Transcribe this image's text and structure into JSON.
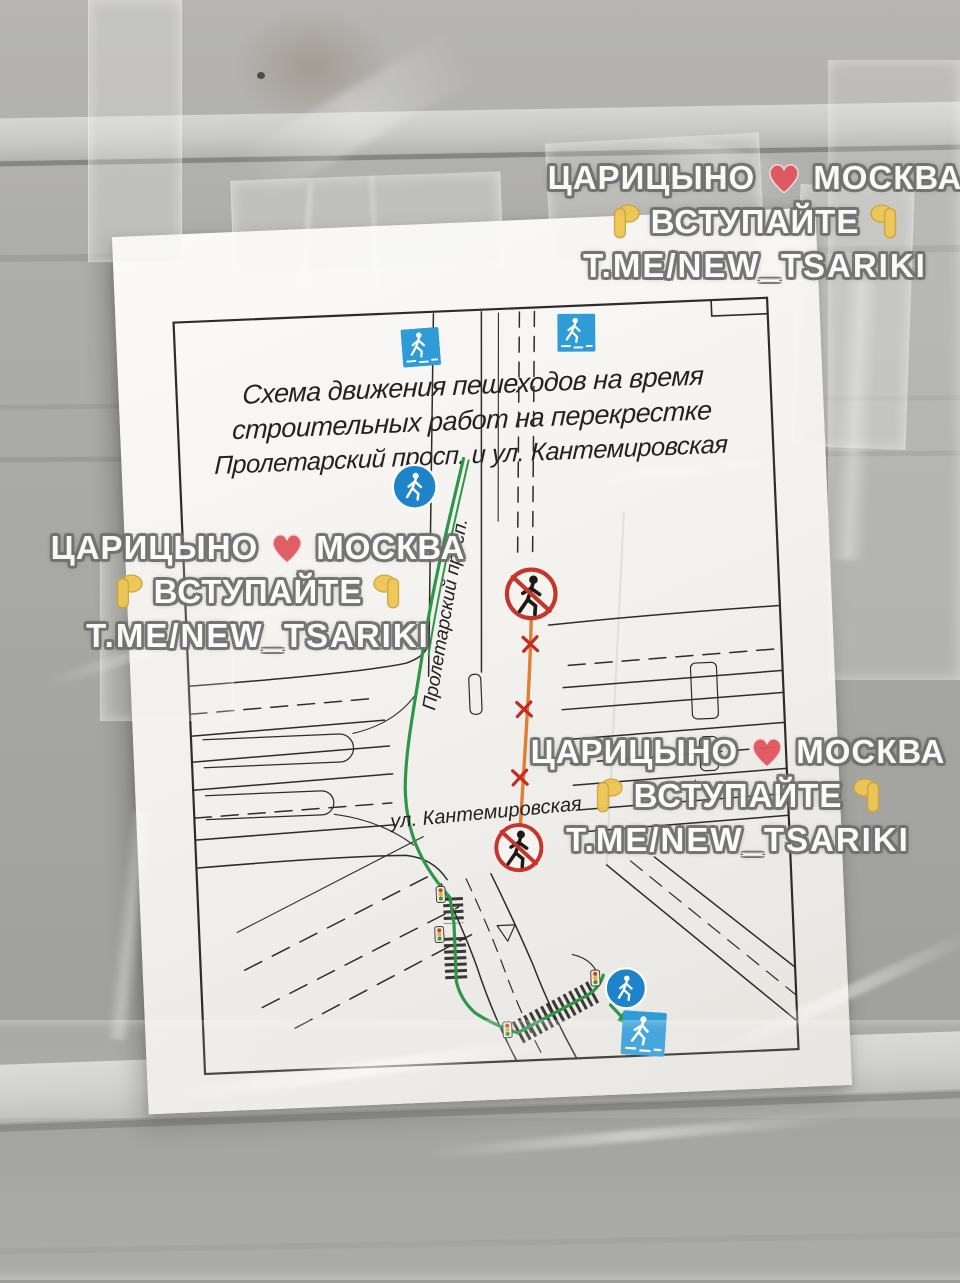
{
  "watermark": {
    "city_left": "ЦАРИЦЫНО",
    "city_right": "МОСКВА",
    "join_label": "ВСТУПАЙТЕ",
    "channel": "T.ME/NEW_TSARIKI",
    "heart_color": "#e25560",
    "hand_color": "#edc654",
    "text_color": "#fdfdfd",
    "outline_color": "#6f6f6d"
  },
  "poster": {
    "title_line1": "Схема движения пешеходов на время",
    "title_line2": "строительных работ на перекрестке",
    "title_line3": "Пролетарский просп. и ул. Кантемировская"
  },
  "map": {
    "street_vertical_label": "Пролетарский просп.",
    "street_horizontal_label": "ул. Кантемировская",
    "route_open_color": "#2e9647",
    "route_closed_color": "#df7e34",
    "closed_cross_color": "#c42a20",
    "sign_blue_square": "#2f9cd8",
    "sign_blue_circle": "#1f83c9",
    "icons": {
      "pedestrian_crossing_sign": "blue square with white pedestrian on zebra",
      "pedestrian_path_sign": "blue circle with white pedestrian",
      "no_pedestrians_sign": "red circle, black pedestrian, red slash",
      "traffic_light": "small signal box with red/yellow/green dots",
      "crosswalk_bar": "black striped ladder bar"
    }
  }
}
